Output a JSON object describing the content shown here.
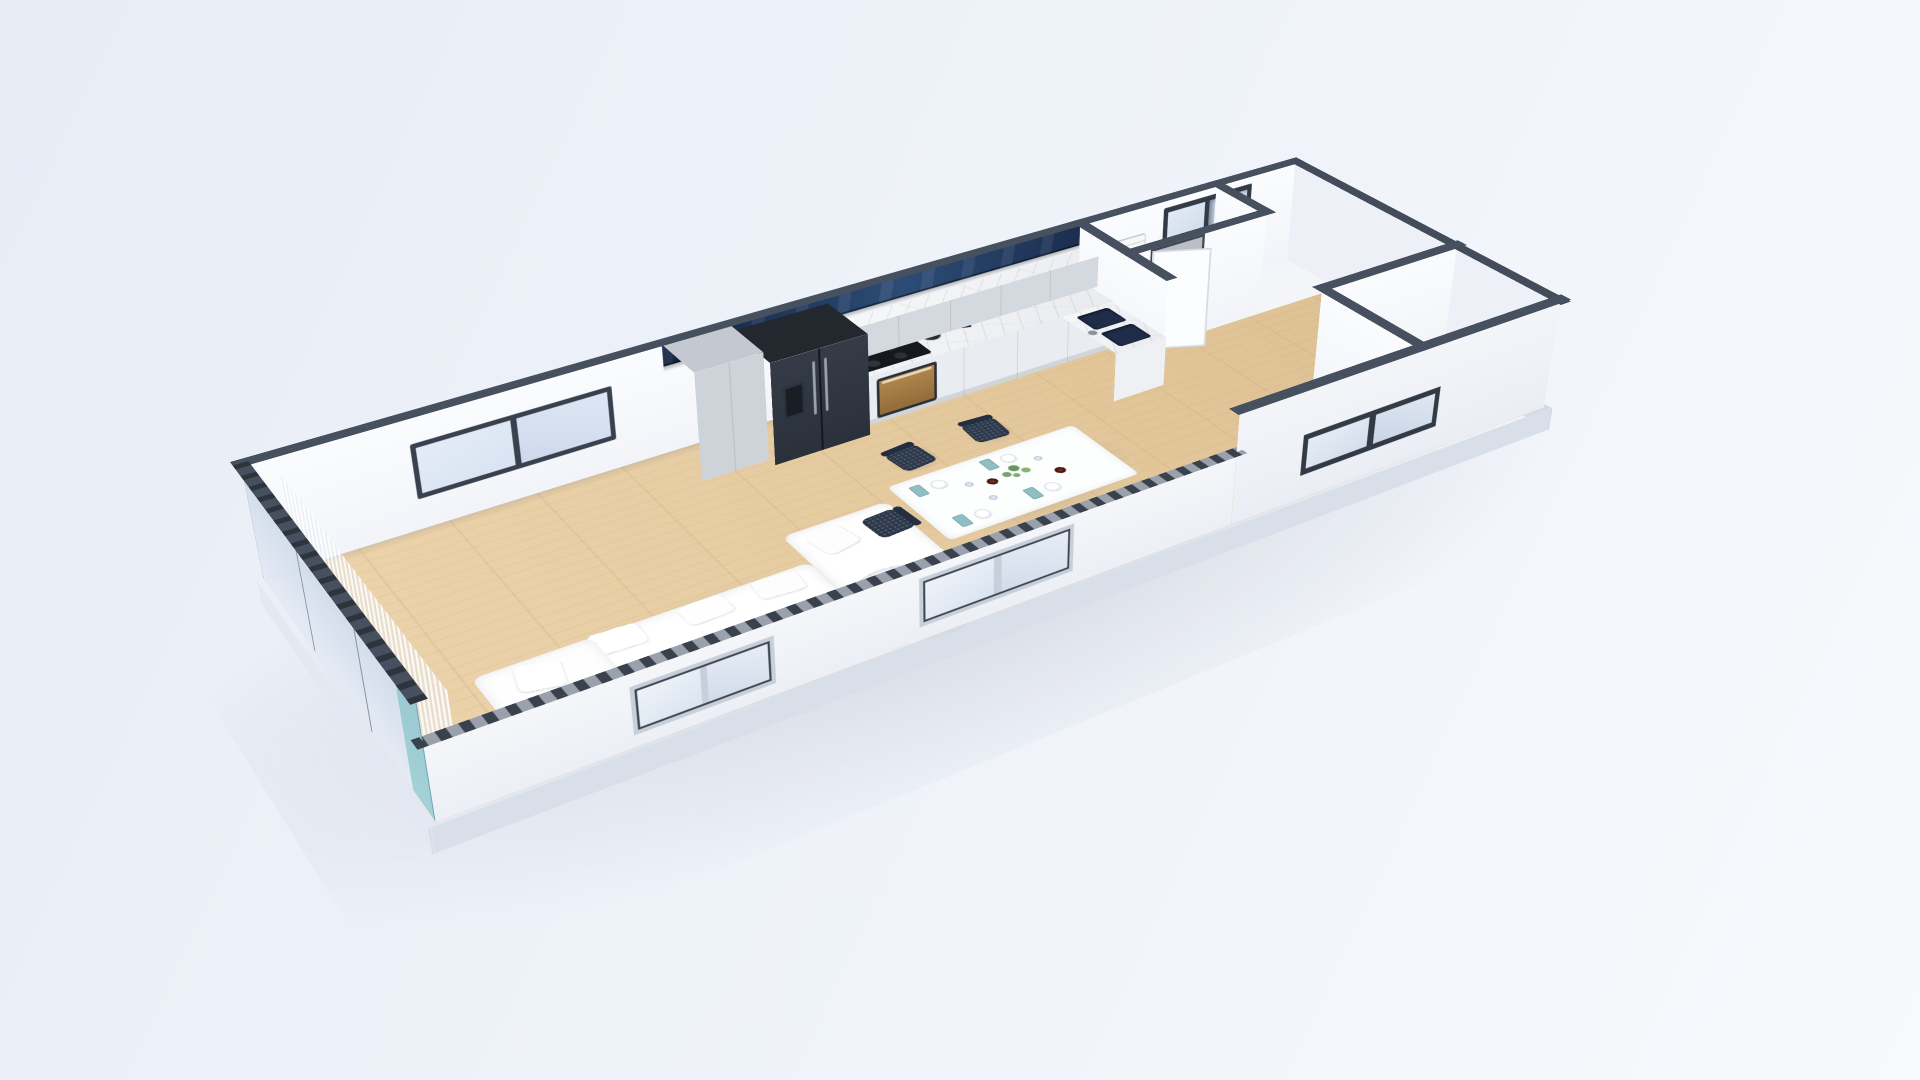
{
  "scene": {
    "type": "3d-floorplan-render",
    "style": "dollhouse cutaway, top-down oblique aerial view, single storey apartment",
    "background": "pale blue-white studio backdrop",
    "no_visible_text": true
  },
  "palette": {
    "bg1": "#e8ecf5",
    "bg2": "#eef2f9",
    "bg3": "#f7f9fc",
    "wood1": "#ecd3ab",
    "wood2": "#ddc092",
    "capDark": "#47505e",
    "capTeeth": "#39414d",
    "capBase": "#9aa1ad",
    "wallWhite": "#fbfcfe",
    "wallExterior": "#f0f3f8",
    "navy1": "#132340",
    "navy2": "#2c4c76",
    "frameDark": "#39414e",
    "glassLight": "#d9e3f2",
    "glassExterior": "#e9eef6",
    "cabinetGray": "#d4d9e0",
    "pantryGray": "#ced3da",
    "fridgeDark": "#2b313b",
    "fridgeTopDark": "#23272e",
    "brass": "#b4894e",
    "cooktopBlack": "#15181d",
    "sinkNavy": "#1f2d4a",
    "chairNavy": "#2d394c",
    "napkinTeal": "#8fbfc2",
    "candleRust": "#6f2c1c",
    "plantGreen": "#6f9e62",
    "branchBrown": "#9a7a52",
    "curtainWhite": "rgba(255,255,255,0.92)",
    "tealGlass": "rgba(110,186,190,0.55)",
    "slabGray": "#d9dfe9",
    "stairTread": "#f8f9fb",
    "stairRiser": "#d3d8e1",
    "marbleWhite": "#f4f5f7"
  },
  "rooms": [
    {
      "name": "living-room",
      "items": [
        "white sectional sofa",
        "white back cushions",
        "white pillows",
        "round marble coffee table",
        "small round side table",
        "decor branch",
        "gray book",
        "sheer white curtain",
        "dark-framed two-pane sliding window",
        "glass balcony wall",
        "teal corner glass pane"
      ]
    },
    {
      "name": "kitchen",
      "items": [
        "navy glass clerestory band",
        "gray upper cabinets",
        "tall pantry cabinet",
        "dark double-door fridge with water dispenser",
        "marble countertop and backsplash",
        "black induction cooktop",
        "dark kettle",
        "brass-front oven",
        "knife block",
        "utensil rail",
        "marble sink peninsula",
        "two navy sink basins",
        "faucet"
      ]
    },
    {
      "name": "dining-area",
      "items": [
        "white dining table",
        "navy perforated chairs",
        "white plates",
        "teal napkins with cutlery",
        "rust candle cups",
        "green plant centerpiece",
        "glasses"
      ]
    },
    {
      "name": "hallway",
      "items": [
        "light oak floor",
        "wall vent panel"
      ]
    },
    {
      "name": "bathroom",
      "items": [
        "white door ajar",
        "white partition walls"
      ]
    },
    {
      "name": "staircase",
      "items": [
        "white treads descending",
        "stair enclosure walls"
      ]
    },
    {
      "name": "exterior",
      "items": [
        "white facade",
        "stud-cut wall top",
        "three facade windows",
        "dark-framed casement window",
        "concrete slab base",
        "soft ground shadow"
      ]
    }
  ],
  "counts": {
    "dining_chairs": 5,
    "place_settings": 4,
    "candle_cups": 2,
    "back_window_panes": 2,
    "facade_windows": 3,
    "stair_treads": 10,
    "sink_basins": 2,
    "fridge_doors": 2
  }
}
